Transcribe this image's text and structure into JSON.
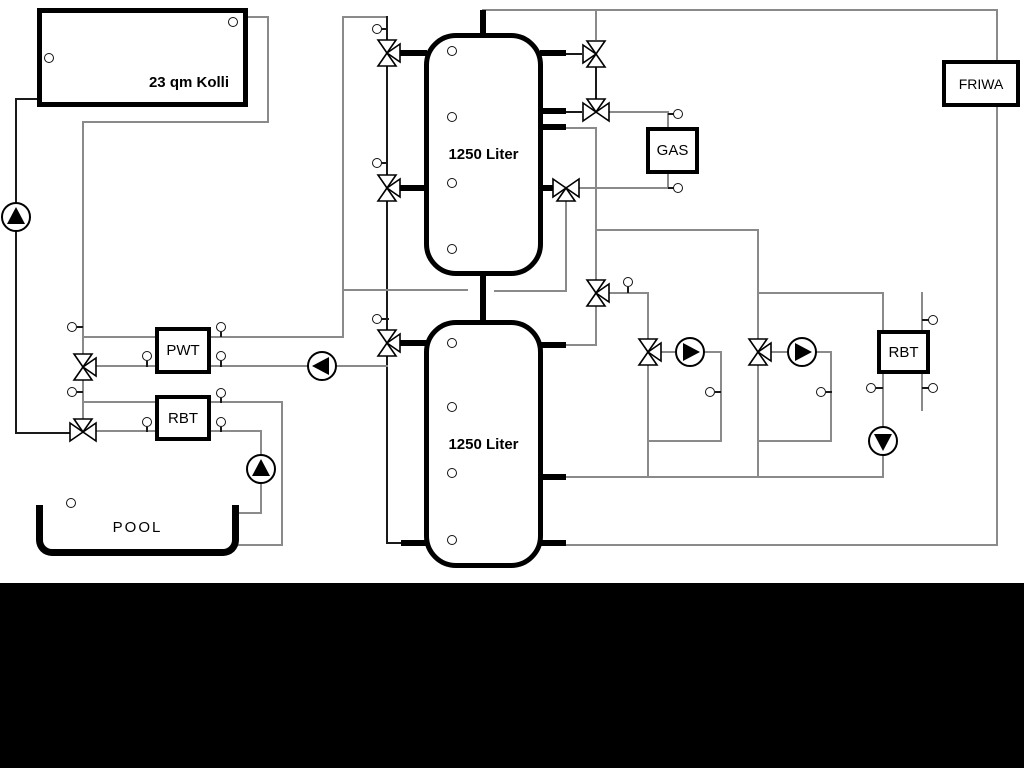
{
  "diagram": {
    "labels": {
      "collector": "23 qm Kolli",
      "upper_tank": "1250 Liter",
      "lower_tank": "1250 Liter",
      "pwt": "PWT",
      "rbt_left": "RBT",
      "gas": "GAS",
      "friwa": "FRIWA",
      "rbt_right": "RBT",
      "pool": "POOL"
    },
    "colors": {
      "pipe_gray": "#8a8a8a",
      "pipe_dark": "#1a1a1a",
      "outline": "#000000",
      "background": "#ffffff",
      "bottom_band": "#000000"
    },
    "components": {
      "pumps": [
        {
          "name": "solar-pump",
          "direction": "up"
        },
        {
          "name": "pwt-secondary-pump",
          "direction": "left"
        },
        {
          "name": "pool-pump",
          "direction": "up"
        },
        {
          "name": "circuit-1-pump",
          "direction": "right"
        },
        {
          "name": "circuit-2-pump",
          "direction": "right"
        },
        {
          "name": "rbt-right-pump",
          "direction": "down"
        }
      ],
      "three_way_valve_count": 11,
      "sensor_port_count": 24
    }
  }
}
